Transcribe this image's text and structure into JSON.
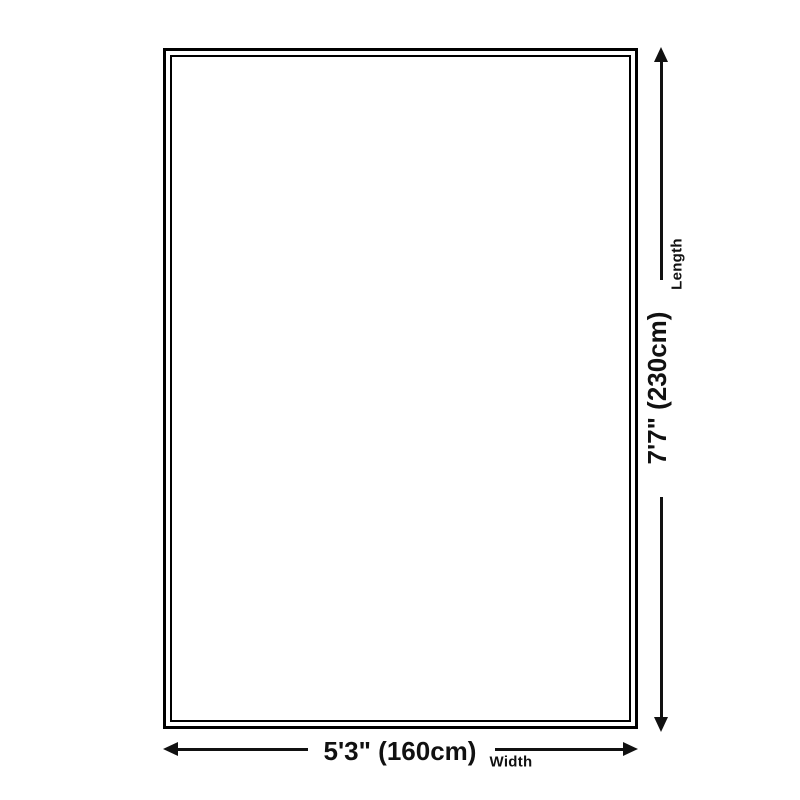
{
  "page": {
    "background": "#ffffff"
  },
  "rug_diagram": {
    "outline_border_color": "#000000",
    "line_color": "#111111",
    "text_color": "#111111",
    "length_dimension": {
      "value": "7'7\" (230cm)",
      "label": "Length"
    },
    "width_dimension": {
      "value": "5'3\" (160cm)",
      "label": "Width"
    }
  }
}
